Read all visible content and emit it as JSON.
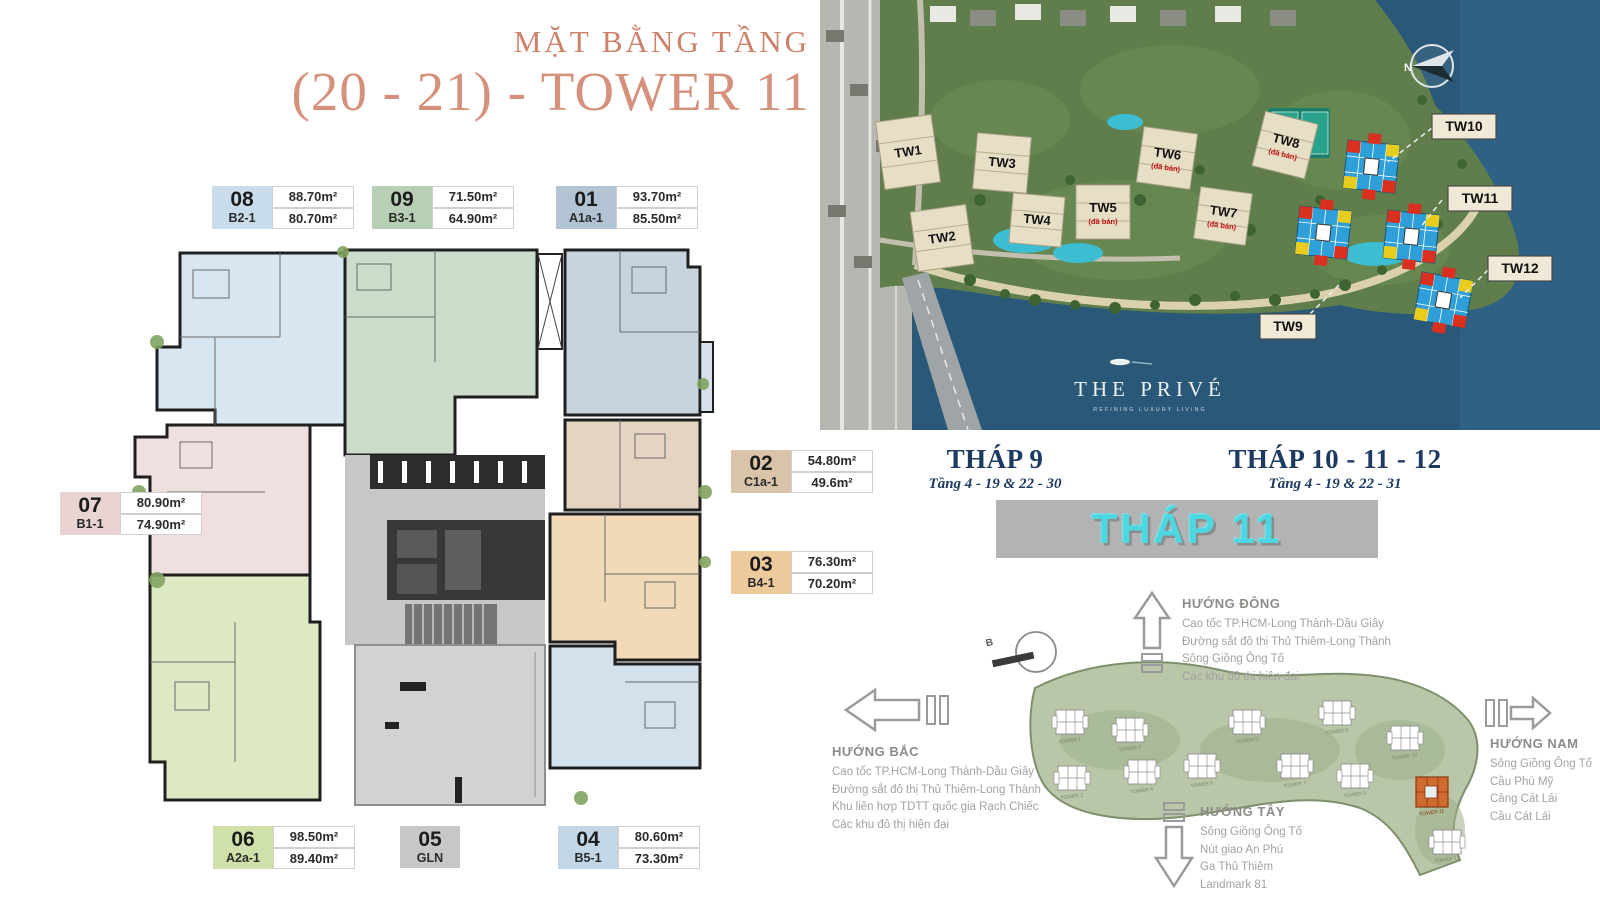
{
  "floor_plan": {
    "title_line1": "MẶT BẰNG TẦNG",
    "title_line2": "(20 - 21) - TOWER 11",
    "title_color": "#d28871",
    "units": [
      {
        "no": "08",
        "code": "B2-1",
        "area_top": "88.70m²",
        "area_bottom": "80.70m²",
        "color": "#c9dcec"
      },
      {
        "no": "09",
        "code": "B3-1",
        "area_top": "71.50m²",
        "area_bottom": "64.90m²",
        "color": "#b7cfb5"
      },
      {
        "no": "01",
        "code": "A1a-1",
        "area_top": "93.70m²",
        "area_bottom": "85.50m²",
        "color": "#b2c4d3"
      },
      {
        "no": "02",
        "code": "C1a-1",
        "area_top": "54.80m²",
        "area_bottom": "49.6m²",
        "color": "#d9c3a9"
      },
      {
        "no": "03",
        "code": "B4-1",
        "area_top": "76.30m²",
        "area_bottom": "70.20m²",
        "color": "#edca9c"
      },
      {
        "no": "04",
        "code": "B5-1",
        "area_top": "80.60m²",
        "area_bottom": "73.30m²",
        "color": "#c2d6e6"
      },
      {
        "no": "05",
        "code": "GLN",
        "area_top": "",
        "area_bottom": "",
        "color": "#c7c7c7"
      },
      {
        "no": "06",
        "code": "A2a-1",
        "area_top": "98.50m²",
        "area_bottom": "89.40m²",
        "color": "#cfe0ab"
      },
      {
        "no": "07",
        "code": "B1-1",
        "area_top": "80.90m²",
        "area_bottom": "74.90m²",
        "color": "#e9d3d3"
      }
    ]
  },
  "site_map": {
    "towers": [
      {
        "label": "TW1"
      },
      {
        "label": "TW2"
      },
      {
        "label": "TW3"
      },
      {
        "label": "TW4"
      },
      {
        "label": "TW5",
        "note": "(đã bán)"
      },
      {
        "label": "TW6",
        "note": "(đã bán)"
      },
      {
        "label": "TW7",
        "note": "(đã bán)"
      },
      {
        "label": "TW8",
        "note": "(đã bán)"
      }
    ],
    "chips": [
      {
        "label": "TW10"
      },
      {
        "label": "TW11"
      },
      {
        "label": "TW12"
      },
      {
        "label": "TW9"
      }
    ],
    "logo_title": "THE PRIVÉ",
    "logo_tagline": "REFINING LUXURY LIVING",
    "compass_label": "N",
    "colors": {
      "water": "#2a5878",
      "land": "#5f7e4b",
      "mosaic_blue": "#2e9fd8",
      "mosaic_red": "#d9301f",
      "mosaic_yellow": "#e8cc1e"
    }
  },
  "headers": {
    "left": {
      "title": "THÁP 9",
      "subtitle": "Tầng 4 - 19 & 22 - 30"
    },
    "right": {
      "title": "THÁP 10 - 11 - 12",
      "subtitle": "Tầng 4 - 19 & 22 - 31"
    },
    "banner": "THÁP 11",
    "banner_text_color": "#4dd7e0",
    "header_color": "#1d3a60"
  },
  "directions": {
    "compass_label": "B",
    "east": {
      "title": "HƯỚNG ĐÔNG",
      "items": [
        "Cao tốc TP.HCM-Long Thành-Dầu Giây",
        "Đường sắt đô thị Thủ Thiêm-Long Thành",
        "Sông Giồng Ông Tố",
        "Các khu đô thị hiện đại"
      ]
    },
    "north": {
      "title": "HƯỚNG BẮC",
      "items": [
        "Cao tốc TP.HCM-Long Thành-Dầu Giây",
        "Đường sắt đô thị Thủ Thiêm-Long Thành",
        "Khu liên hợp TDTT quốc gia Rạch Chiếc",
        "Các khu đô thị hiện đại"
      ]
    },
    "west": {
      "title": "HƯỚNG TÂY",
      "items": [
        "Sông Giồng Ông Tố",
        "Nút giao An Phú",
        "Ga Thủ Thiêm",
        "Landmark 81"
      ]
    },
    "south": {
      "title": "HƯỚNG NAM",
      "items": [
        "Sông Giồng Ông Tố",
        "Cầu Phú Mỹ",
        "Cảng Cát Lái",
        "Cầu Cát Lái"
      ]
    }
  },
  "site_diagram": {
    "tower_labels": [
      "TOWER 1",
      "TOWER 3",
      "TOWER 5",
      "TOWER 8",
      "TOWER 10",
      "TOWER 2",
      "TOWER 4",
      "TOWER 6",
      "TOWER 7",
      "TOWER 9",
      "TOWER 11",
      "TOWER 12"
    ],
    "highlighted": "TOWER 11",
    "highlight_color": "#cf6a30"
  }
}
